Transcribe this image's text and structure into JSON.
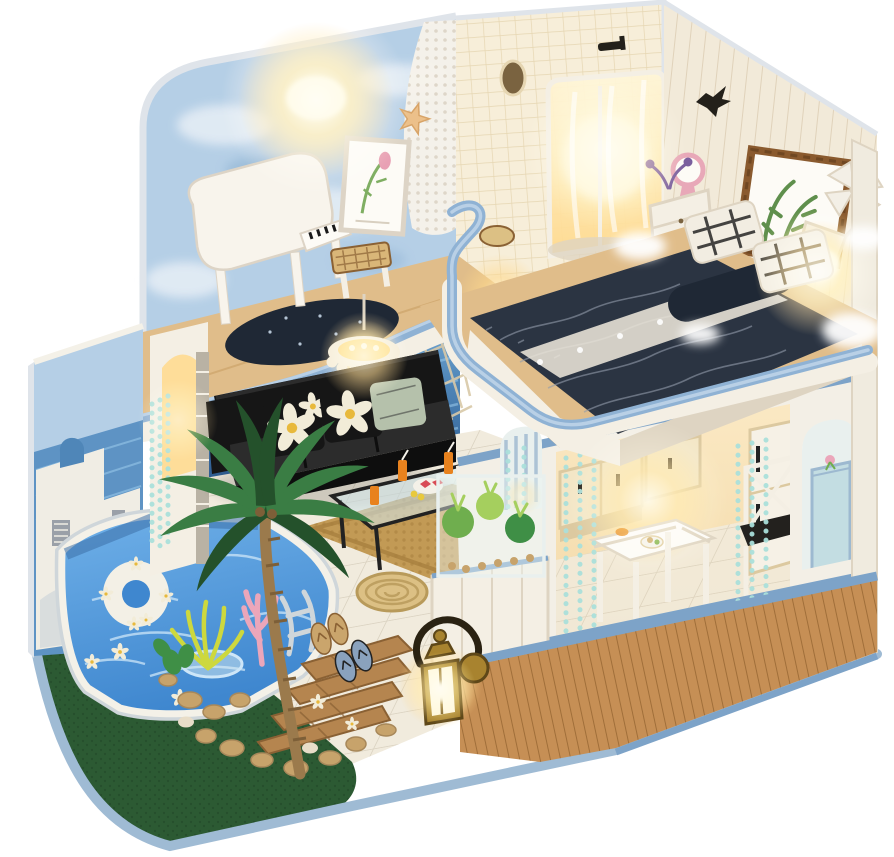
{
  "meta": {
    "title_hint": "photograph of a miniature DIY dollhouse, ocean villa theme, on white background",
    "visible_text": []
  },
  "scene": {
    "objects": [
      "sky-cloud-mural-wall",
      "warm-ceiling-lamp-glow",
      "white-grand-piano",
      "piano-bench",
      "framed-art-print",
      "white-mesh-net-curtain",
      "starfish-decor",
      "loft-balcony-blue-railing",
      "dark-round-rug",
      "shower-room-glass-enclosure",
      "round-mirror",
      "shower-head",
      "wicker-basket",
      "bedroom-plank-wall",
      "bird-silhouette-decor",
      "twig-picture-frame",
      "windmill-decor",
      "glowing-wall-lamp",
      "pink-round-mirror",
      "white-nightstand",
      "double-bed-navy-bedding",
      "lace-runner",
      "plaid-pillows",
      "cotton-cloud-decor",
      "bed-loft-blue-railing",
      "ocean-water-mural",
      "wall-shelf-with-books",
      "rope-net",
      "pompom-chandelier",
      "black-sofa",
      "daisy-pillows",
      "sage-pillow",
      "glass-coffee-table",
      "fruit-tray",
      "orange-drinks",
      "jute-rug",
      "rope-pouf",
      "stone-column-arch",
      "teal-bead-curtains",
      "kitchen-cabinets",
      "white-dining-table",
      "dining-chair-black-cushion",
      "fridge",
      "arched-window",
      "pale-blue-cabinet",
      "glass-planter-box",
      "green-plants",
      "swimming-pool",
      "pool-white-rim",
      "swim-ring",
      "red-floating-flowers",
      "pool-ladder",
      "glass-side-table",
      "santorini-mural-wall",
      "palm-tree",
      "pink-coral-plant",
      "yellow-spiky-plant",
      "wooden-steps",
      "pebbles",
      "artificial-grass",
      "flip-flops",
      "brass-lantern",
      "wood-plank-base-skirt",
      "light-blue-base-rim"
    ]
  },
  "palette": {
    "bg": "#ffffff",
    "edge_light": "#dfe4ea",
    "base_rim": "#9fbbd4",
    "grass": "#2c5a33",
    "grass_dark": "#1f4426",
    "tile": "#f1ebdd",
    "tile_line": "#dbd3c2",
    "wood_floor": "#e0bd8a",
    "wood_line": "#c9a065",
    "skirt_wood": "#c68f55",
    "skirt_line": "#9c6b36",
    "trim_blue": "#7da3c8",
    "rail_blue": "#8fb2d4",
    "rail_light": "#cfe0f0",
    "sky_wall": "#b5cfe6",
    "sky_cloud": "#eef3f8",
    "sky_shadow": "#8fb3d2",
    "ocean": "#4f86b8",
    "ocean_light": "#8fc0e4",
    "ocean_dark": "#2f5d92",
    "mural_sea": "#5e93c4",
    "mural_white": "#f0ede4",
    "mural_gray": "#9aa0a8",
    "pool_water": "#3f87cf",
    "pool_light": "#6fb0e8",
    "pool_ripple": "#cde6f8",
    "pool_rim": "#f4f1e8",
    "pool_rim_shadow": "#cfd6da",
    "pool_wall": "#3c6fa8",
    "ring_white": "#f3f0e6",
    "flower_red": "#d8374a",
    "flower_white": "#f5f2ea",
    "sofa_black": "#161616",
    "sofa_dark": "#0e0e0e",
    "sofa_hi": "#2c2c2c",
    "pillow_petal": "#f2ecd8",
    "pillow_center": "#e8b93c",
    "pillow_sage": "#b5c1ab",
    "rug_jute": "#c29a55",
    "rug_border": "#a87f3e",
    "pouf": "#dcc084",
    "pouf_line": "#b89a5a",
    "glass": "#d7ecf2",
    "frame_black": "#222222",
    "orange_drink": "#e8821e",
    "melon_red": "#d84b55",
    "lemon": "#e8c93c",
    "chand_cream": "#f5ecd8",
    "glow_warm": "#ffd98c",
    "glow_hot": "#fff6d8",
    "piano_white": "#f8f4ec",
    "piano_shadow": "#ddd4c6",
    "key_black": "#1a1a1a",
    "bench_weave": "#d9b678",
    "frame_white": "#fdfbf6",
    "art_pink": "#e8a0b4",
    "art_green": "#7fae62",
    "net_white": "#f7f3ea",
    "net_dot": "#d8cfc0",
    "starfish": "#ecc08a",
    "starfish_dark": "#d8a468",
    "bath_tile": "#f7eed9",
    "bath_grid": "#e6d6b2",
    "mirror_dark": "#7a6340",
    "fixture_black": "#23201a",
    "bedroom_wall": "#f2ead9",
    "bedroom_plank": "#e0d2ba",
    "twig_brown": "#8a5a2e",
    "twig_dark": "#6f4722",
    "leaf_green": "#5f8f4c",
    "windmill_white": "#f3efe6",
    "mirror_pink": "#e8a8b8",
    "furn_white": "#f4efe4",
    "furn_shadow": "#ded4c2",
    "bed_navy": "#2b3442",
    "bed_roll": "#1f2835",
    "bed_wave": "#939cab",
    "lace": "#ebe5d8",
    "pillow_white": "#f2ede2",
    "pillow_stripe": "#262626",
    "cloud_white": "#ffffff",
    "dining_wall": "#f3efe6",
    "room_warm": "#fbe9c4",
    "room_warm2": "#f2d8a6",
    "cab_cream": "#f3e6c6",
    "cab_line": "#dcc9a0",
    "bead_teal": "#aadfda",
    "cushion_black": "#23211e",
    "arch_blue": "#c3dde2",
    "arch_bg": "#e9f0ee",
    "stripe_blue": "#9db9d0",
    "planter_glass": "#eef6f2",
    "plant_a": "#6fae4e",
    "plant_b": "#a5cf5e",
    "plant_c": "#3f8f46",
    "pebble": "#c7a36b",
    "pebble_dark": "#a8885a",
    "pebble_light": "#e8ddc8",
    "step_wood": "#b5854f",
    "step_dark": "#8a6134",
    "palm_front": "#3a7d44",
    "palm_back": "#24512b",
    "trunk": "#9b7a4c",
    "trunk_dark": "#7d5f38",
    "plant_yellow": "#cdd83e",
    "plant_pink": "#eba6ba",
    "ff_tan": "#caa56c",
    "ff_blue": "#8aa2bd",
    "brass": "#a8832f",
    "brass_dark": "#5e4718",
    "handle_dark": "#2a2212",
    "stone_gray": "#b9b2a4",
    "shelf_white": "#f3efe4",
    "book_orange": "#d8852a",
    "book_rust": "#c2622a",
    "book_purple": "#7a5f9e",
    "post_white": "#f0ebdf",
    "rope": "#d9c9a8",
    "fridge_white": "#f6f1e6"
  }
}
